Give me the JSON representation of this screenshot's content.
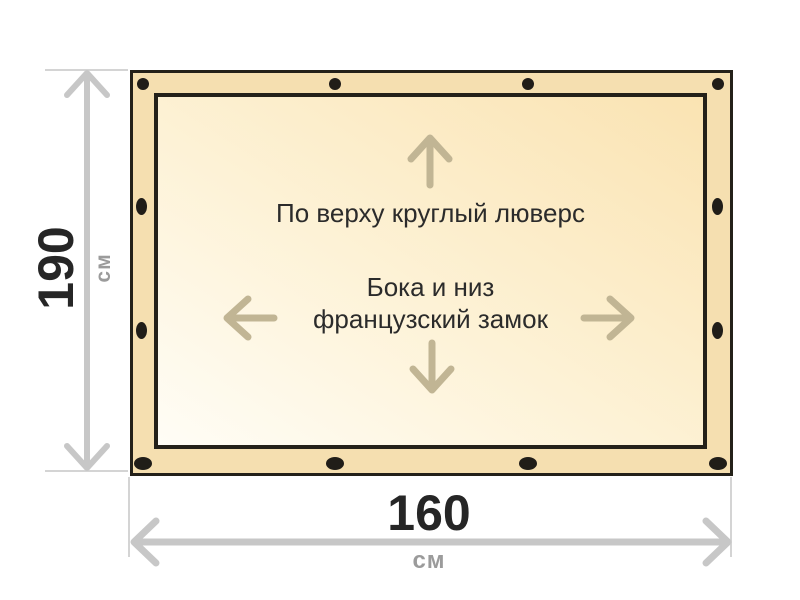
{
  "annotations": {
    "top": "По верху круглый люверс",
    "middle_line1": "Бока и низ",
    "middle_line2": "французский замок"
  },
  "dimensions": {
    "height": {
      "value": "190",
      "unit": "см"
    },
    "width": {
      "value": "160",
      "unit": "см"
    }
  },
  "icons": {
    "grommet": "black-oval-dot",
    "grommet_count": 12,
    "direction_arrows": [
      "arrow-up",
      "arrow-left",
      "arrow-right",
      "arrow-down"
    ],
    "measure_arrows": [
      "double-arrow-vertical",
      "double-arrow-horizontal"
    ]
  },
  "colors": {
    "band": "#f5dfb0",
    "surface-light": "#fffdf6",
    "surface-dark": "#fae3b2",
    "outline": "#242119",
    "grommet": "#201d18",
    "content-arrow": "#c1b594",
    "measure": "#c7c7c7",
    "ext": "#d4d4d4",
    "number": "#262626",
    "unit": "#9b9b9b",
    "text": "#2b2b2b"
  }
}
